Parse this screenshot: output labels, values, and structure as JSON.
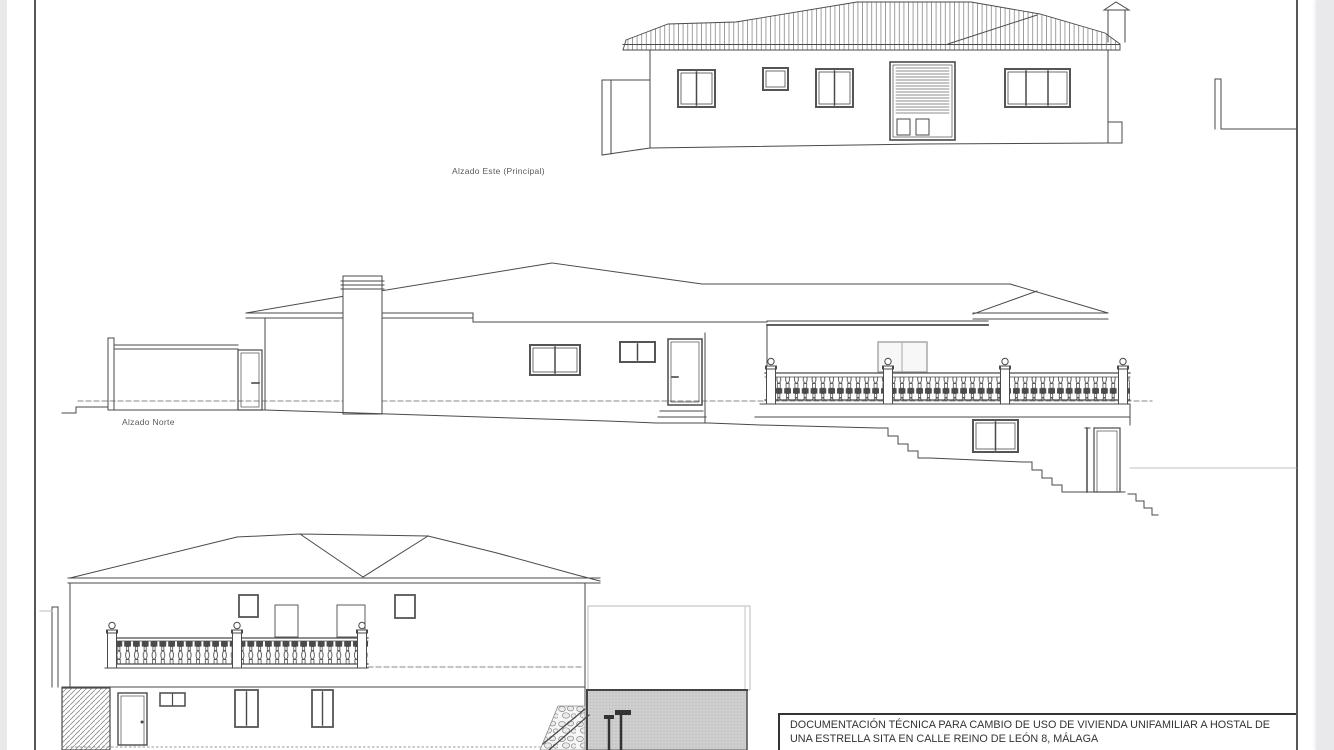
{
  "sheet": {
    "type": "architectural-elevations-drawing",
    "paper_color": "#ffffff",
    "line_color": "#4a4a4a",
    "gutter_color": "#e9e9ec",
    "border_color": "#55565a"
  },
  "labels": {
    "east_elevation": "Alzado Este (Principal)",
    "north_elevation": "Alzado Norte"
  },
  "title_block": {
    "line1": "DOCUMENTACIÓN TÉCNICA PARA CAMBIO DE USO DE VIVIENDA UNIFAMILIAR A HOSTAL DE",
    "line2": "UNA ESTRELLA SITA EN CALLE REINO DE LEÓN 8, MÁLAGA"
  }
}
